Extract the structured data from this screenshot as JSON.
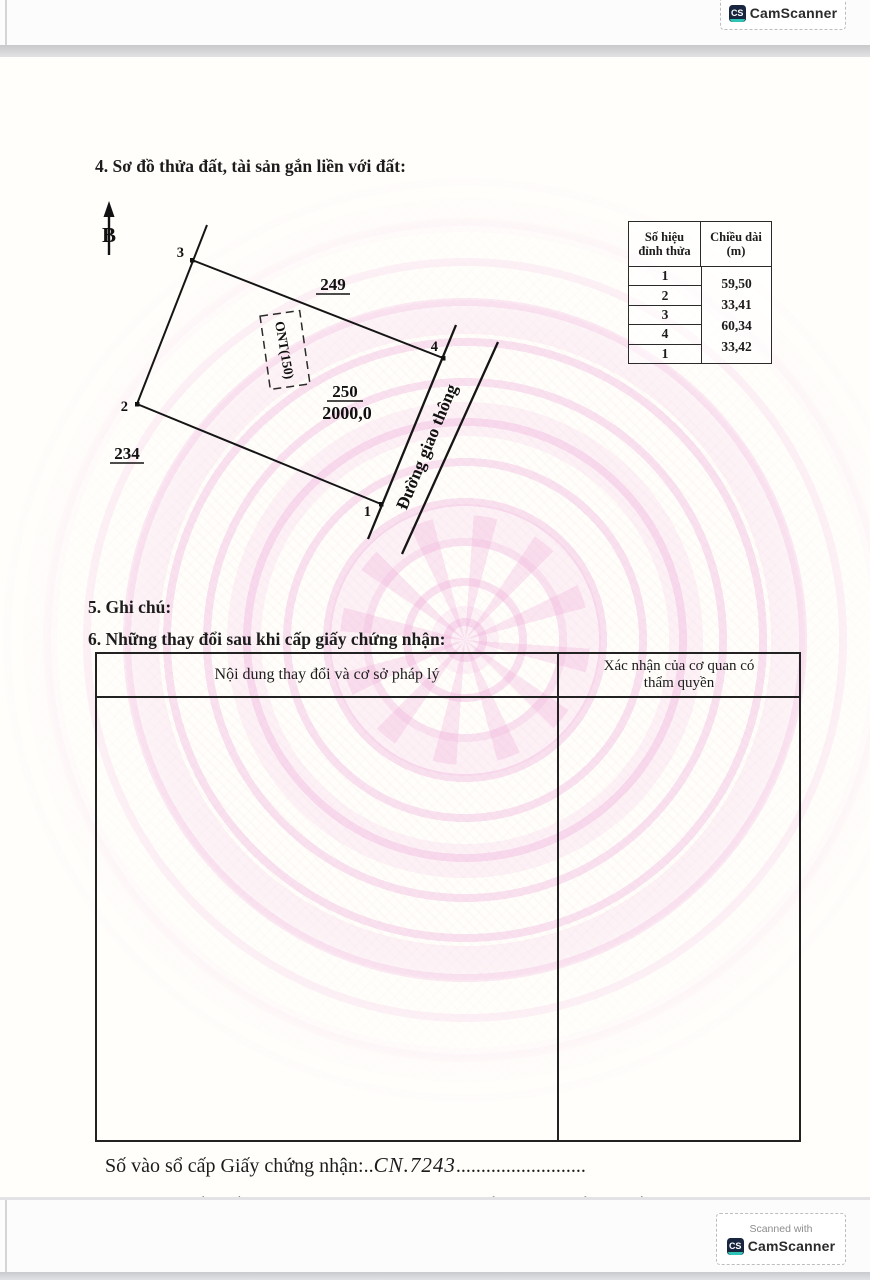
{
  "scanner": {
    "scanned_with": "Scanned with",
    "brand": "CamScanner",
    "logo_text": "CS"
  },
  "section4": {
    "title": "4. Sơ đồ thửa đất, tài sản gắn liền với đất:",
    "diagram": {
      "north_label": "B",
      "vertex1": "1",
      "vertex2": "2",
      "vertex3": "3",
      "vertex4": "4",
      "adjacent_top": "249",
      "adjacent_left": "234",
      "parcel_number": "250",
      "parcel_area": "2000,0",
      "land_use_label": "ONT(150)",
      "road_label": "Đường giao thông"
    },
    "edge_table": {
      "col1_header": "Số hiệu đỉnh thửa",
      "col2_header": "Chiều dài (m)",
      "vertices": [
        "1",
        "2",
        "3",
        "4",
        "1"
      ],
      "lengths": [
        "59,50",
        "33,41",
        "60,34",
        "33,42"
      ]
    }
  },
  "section5": {
    "title": "5. Ghi chú:"
  },
  "section6": {
    "title": "6. Những thay đổi sau khi cấp giấy chứng nhận:",
    "table": {
      "col1_header": "Nội dung thay đổi và cơ sở pháp lý",
      "col2_header": "Xác nhận của cơ quan có thẩm quyền"
    }
  },
  "footer": {
    "serial_label": "Số vào sổ cấp Giấy chứng nhận:",
    "serial_dots_before": "..",
    "serial_value": "CN.7243",
    "serial_dots_after": "..........................",
    "notice_line1": "Người được cấp Giấy chứng nhận không được sửa chữa, tẩy xóa hoặc bổ sung bất kỳ nội dung nào trong",
    "notice_line2": "Giấy chứng nhận; khi bị mất hoặc hư hỏng Giấy chứng nhận phải khai báo ngay với cơ quan cấp Giấy."
  }
}
